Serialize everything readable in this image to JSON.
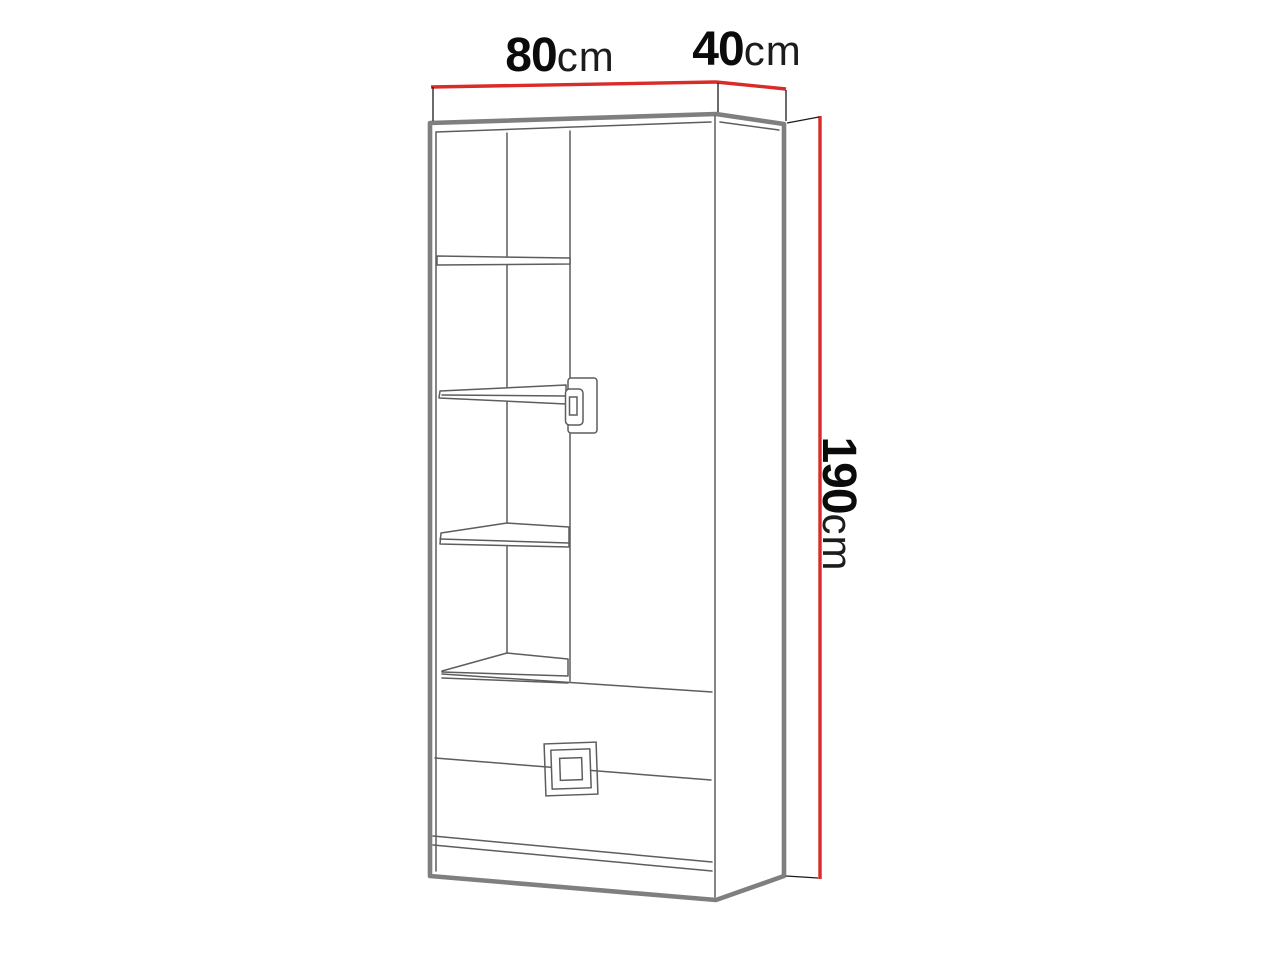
{
  "diagram": {
    "name": "wardrobe-dimension-drawing",
    "dimensions": {
      "width": {
        "value": "80",
        "unit": "cm"
      },
      "depth": {
        "value": "40",
        "unit": "cm"
      },
      "height": {
        "value": "190",
        "unit": "cm"
      }
    },
    "colors": {
      "dimension_line": "#d92b27",
      "outline_thick": "#7f7f7f",
      "outline_thin": "#5d5d5d",
      "tick_line": "#1a1a1a",
      "label_number": "#0b0b0b",
      "label_unit": "#1c1c1c",
      "background": "#ffffff"
    }
  }
}
